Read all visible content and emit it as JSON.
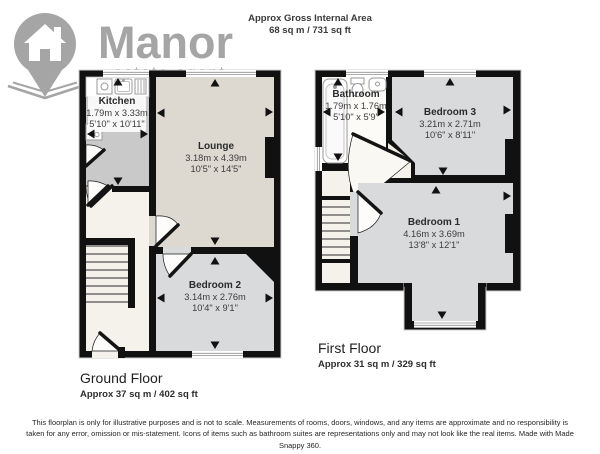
{
  "header": {
    "area_label": "Approx Gross Internal Area",
    "area_value": "68 sq m / 731 sq ft"
  },
  "logo": {
    "brand": "Manor",
    "tagline": "estate agent"
  },
  "floors": {
    "ground": {
      "title": "Ground Floor",
      "area": "Approx 37 sq m / 402 sq ft",
      "rooms": {
        "kitchen": {
          "name": "Kitchen",
          "metric": "1.79m x 3.33m",
          "imperial": "5'10\" x 10'11\""
        },
        "lounge": {
          "name": "Lounge",
          "metric": "3.18m x 4.39m",
          "imperial": "10'5\" x 14'5\""
        },
        "bedroom2": {
          "name": "Bedroom 2",
          "metric": "3.14m x 2.76m",
          "imperial": "10'4\" x 9'1\""
        }
      }
    },
    "first": {
      "title": "First Floor",
      "area": "Approx 31 sq m / 329 sq ft",
      "rooms": {
        "bathroom": {
          "name": "Bathroom",
          "metric": "1.79m x 1.76m",
          "imperial": "5'10\" x 5'9\""
        },
        "bedroom3": {
          "name": "Bedroom 3",
          "metric": "3.21m x 2.71m",
          "imperial": "10'6\" x 8'11\""
        },
        "bedroom1": {
          "name": "Bedroom 1",
          "metric": "4.16m x 3.69m",
          "imperial": "13'8\" x 12'1\""
        }
      }
    }
  },
  "disclaimer": "This floorplan is only for illustrative purposes and is not to scale. Measurements of rooms, doors, windows, and any items are approximate and no responsibility is taken for any error, omission or mis-statement. Icons of items such as bathroom suites are representations only and may not look like the real items. Made with Made Snappy 360.",
  "colors": {
    "wall": "#111111",
    "lounge_floor": "#ddd8d0",
    "bedroom_floor": "#d9dadb",
    "kitchen_floor": "#c9c9c9",
    "hall_floor": "#f5f2eb",
    "bathroom_floor": "#fcfbf7",
    "logo_gray": "#a5a5a5"
  }
}
